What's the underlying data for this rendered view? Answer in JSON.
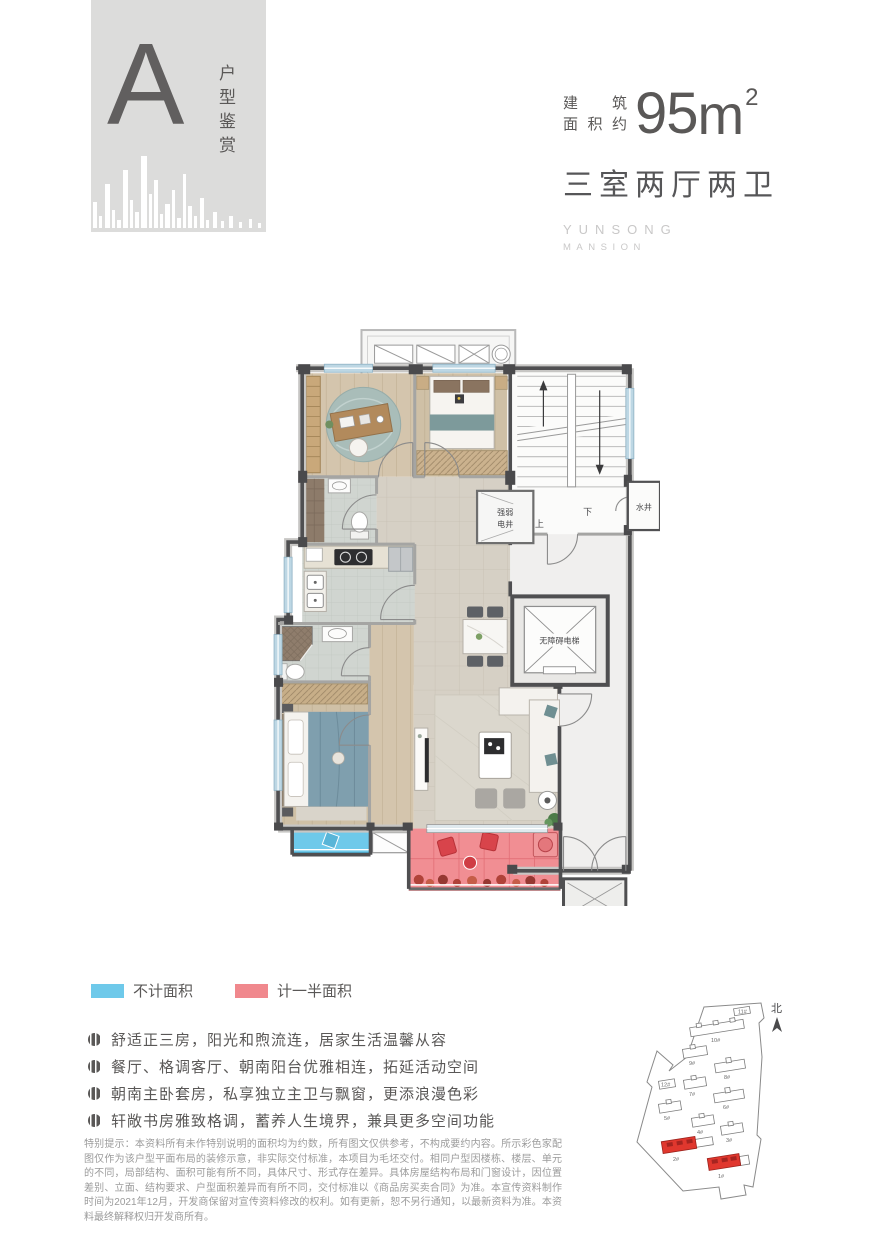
{
  "header": {
    "unit_letter": "A",
    "unit_series_label": "户型鉴赏",
    "area_label_line1": "建筑",
    "area_label_line2": "面积约",
    "area_number": "95",
    "area_unit": "m",
    "area_exponent": "2",
    "rooms_summary": "三室两厅两卫",
    "brand_line1": "YUNSONG",
    "brand_line2": "MANSION"
  },
  "floorplan": {
    "elevator_label": "无障碍电梯",
    "electric_shaft_line1": "强弱",
    "electric_shaft_line2": "电井",
    "water_shaft_label": "水井",
    "stairs_up_label": "上",
    "stairs_down_label": "下"
  },
  "legend": {
    "items": [
      {
        "label": "不计面积",
        "color": "#6ec9ea"
      },
      {
        "label": "计一半面积",
        "color": "#f0888d"
      }
    ]
  },
  "features": [
    {
      "text": "舒适正三房，阳光和煦流连，居家生活温馨从容"
    },
    {
      "text": "餐厅、格调客厅、朝南阳台优雅相连，拓延活动空间"
    },
    {
      "text": "朝南主卧套房，私享独立主卫与飘窗，更添浪漫色彩"
    },
    {
      "text": "轩敞书房雅致格调，蓄养人生境界，兼具更多空间功能"
    }
  ],
  "disclaimer": "特别提示：本资料所有未作特别说明的面积均为约数，所有图文仅供参考，不构成要约内容。所示彩色家配图仅作为该户型平面布局的装修示意，非实际交付标准，本项目为毛坯交付。相同户型因楼栋、楼层、单元的不同，局部结构、面积可能有所不同，具体尺寸、形式存在差异。具体房屋结构布局和门窗设计，因位置差别、立面、结构要求、户型面积差异而有所不同，交付标准以《商品房买卖合同》为准。本宣传资料制作时间为2021年12月，开发商保留对宣传资料修改的权利。如有更新，恕不另行通知，以最新资料为准。本资料最终解释权归开发商所有。",
  "siteplan": {
    "north_label": "北",
    "highlight_color": "#e0372e",
    "buildings": [
      {
        "id": "11#",
        "highlight": false
      },
      {
        "id": "10#",
        "highlight": false
      },
      {
        "id": "9#",
        "highlight": false
      },
      {
        "id": "8#",
        "highlight": false
      },
      {
        "id": "12#",
        "highlight": false
      },
      {
        "id": "7#",
        "highlight": false
      },
      {
        "id": "6#",
        "highlight": false
      },
      {
        "id": "5#",
        "highlight": false
      },
      {
        "id": "4#",
        "highlight": false
      },
      {
        "id": "3#",
        "highlight": false
      },
      {
        "id": "2#",
        "highlight": true
      },
      {
        "id": "1#",
        "highlight": true
      }
    ]
  }
}
